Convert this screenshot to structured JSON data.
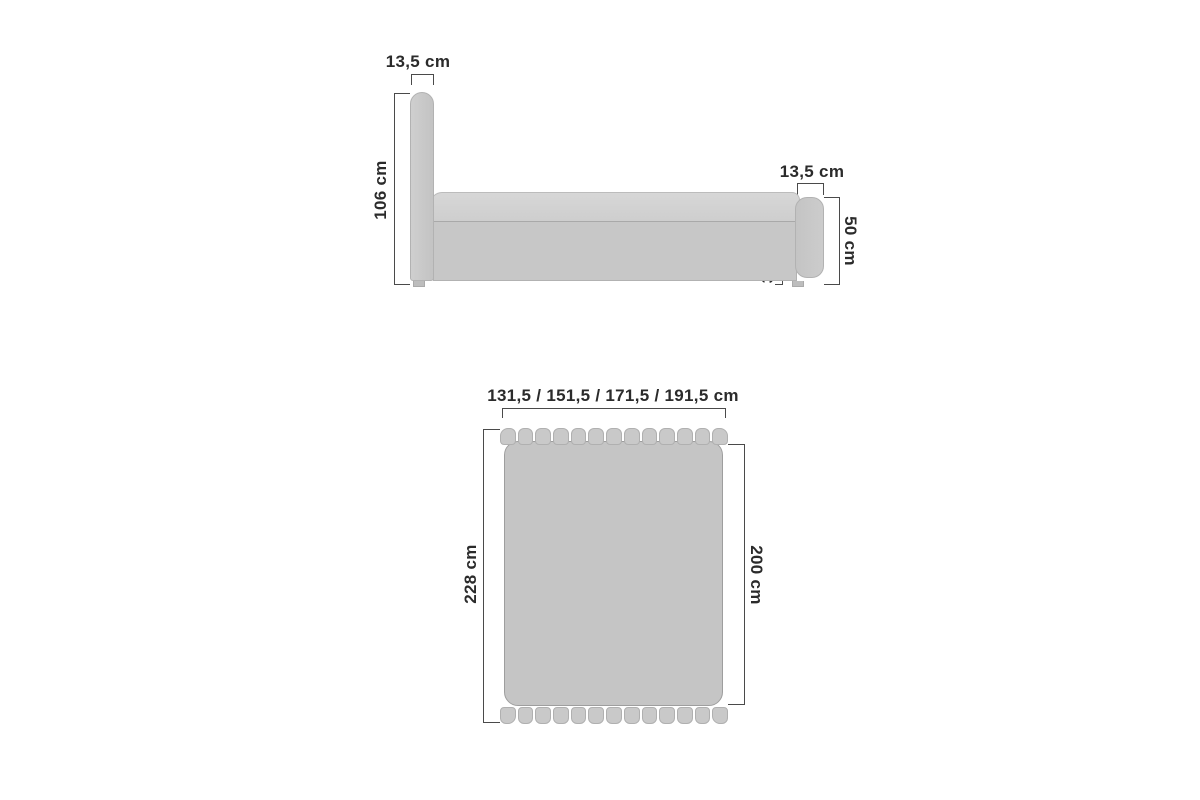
{
  "diagram_title": "bed-dimensions-diagram",
  "side_view": {
    "headboard_width_label": "13,5 cm",
    "headboard_height_label": "106 cm",
    "footboard_width_label": "13,5 cm",
    "base_height_label": "33,5 cm",
    "footboard_height_label": "50 cm"
  },
  "top_view": {
    "overall_width_label": "131,5 / 151,5 / 171,5 / 191,5 cm",
    "mattress_width_label": "120 / 140 / 160 / 180  cm",
    "overall_length_label": "228 cm",
    "mattress_length_label": "200 cm"
  },
  "colors": {
    "background": "#ffffff",
    "furniture_fill": "#c7c7c7",
    "mattress_fill": "#d3d3d3",
    "outline": "#b2b2b2",
    "dimension_line": "#4a4a4a",
    "text": "#2b2b2b"
  }
}
